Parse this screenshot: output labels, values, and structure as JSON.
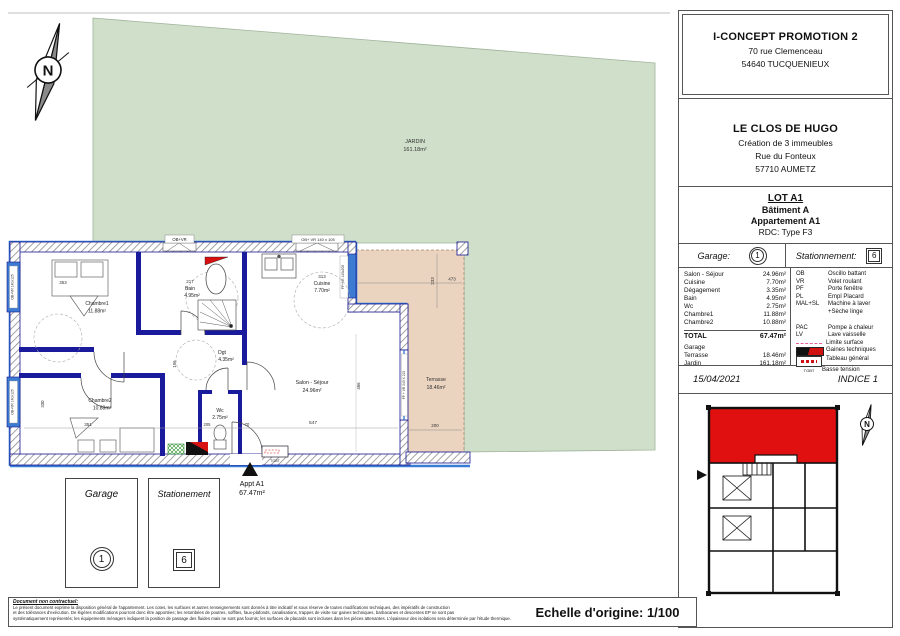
{
  "header": {
    "promoter": {
      "name": "I-CONCEPT PROMOTION 2",
      "address_line1": "70 rue Clemenceau",
      "address_line2": "54640 TUCQUENIEUX"
    },
    "project": {
      "name": "LE CLOS DE HUGO",
      "desc": "Création de 3 immeubles",
      "street": "Rue du Fonteux",
      "city": "57710 AUMETZ"
    },
    "lot": {
      "lot": "LOT A1",
      "building": "Bâtiment A",
      "apartment": "Appartement A1",
      "floor_type": "RDC: Type F3"
    },
    "parking": {
      "garage_label": "Garage:",
      "garage_value": "1",
      "parking_label": "Stationnement:",
      "parking_value": "6"
    },
    "areas": {
      "rooms": [
        {
          "name": "Salon - Séjour",
          "value": "24.96m²"
        },
        {
          "name": "Cuisine",
          "value": "7.70m²"
        },
        {
          "name": "Dégagement",
          "value": "3.35m²"
        },
        {
          "name": "Bain",
          "value": "4.95m²"
        },
        {
          "name": "Wc",
          "value": "2.75m²"
        },
        {
          "name": "Chambre1",
          "value": "11.88m²"
        },
        {
          "name": "Chambre2",
          "value": "10.88m²"
        }
      ],
      "total_label": "TOTAL",
      "total_value": "67.47m²",
      "annexes": [
        {
          "name": "Garage",
          "value": ""
        },
        {
          "name": "Terrasse",
          "value": "18.46m²"
        },
        {
          "name": "Jardin",
          "value": "161.18m²"
        }
      ]
    },
    "legend": {
      "abbrev": [
        {
          "code": "OB",
          "label": "Oscillo battant"
        },
        {
          "code": "VR",
          "label": "Volet roulant"
        },
        {
          "code": "PF",
          "label": "Porte fenêtre"
        },
        {
          "code": "PL",
          "label": "Empl Placard"
        },
        {
          "code": "MAL+SL",
          "label": "Machine à laver"
        },
        {
          "code": "",
          "label": "+Sèche linge"
        },
        {
          "code": "PAC",
          "label": "Pompe à chaleur"
        },
        {
          "code": "LV",
          "label": "Lave vaisselle"
        }
      ],
      "symbols": [
        {
          "label": "Limite surface"
        },
        {
          "label": "Gaines techniques"
        },
        {
          "label": "Tableau général"
        },
        {
          "label": "Basse tension"
        }
      ],
      "tgbt_label": "TGBT"
    },
    "date": "15/04/2021",
    "indice": "INDICE 1"
  },
  "plan": {
    "jardin_name": "JARDIN",
    "jardin_area": "161.18m²",
    "terrasse_name": "Terrasse",
    "terrasse_area": "18.46m²",
    "salon_name": "Salon - Séjour",
    "salon_area": "24.96m²",
    "cuisine_num": "313",
    "cuisine_name": "Cuisine",
    "cuisine_area": "7.70m²",
    "bain_num": "217",
    "bain_name": "Bain",
    "bain_area": "4.95m²",
    "chambre1_name": "Chambre1",
    "chambre1_area": "11.88m²",
    "chambre1_num": "353",
    "chambre2_name": "Chambre2",
    "chambre2_area": "10.88m²",
    "chambre2_num": "351",
    "dgt_name": "Dgt",
    "dgt_area": "4.35m²",
    "wc_name": "Wc",
    "wc_area": "2.75m²",
    "windows": {
      "top_small": "OB+VR",
      "top_cuisine": "OB+ VR 140 x 105",
      "left1": "OB+VR 140x125",
      "left2": "OB+VR 140x125",
      "salon_pf": "PF + VR 240 X 215",
      "cuisine_pf": "PF+VR 140x205"
    },
    "dims": {
      "d547": "547",
      "d200": "200",
      "d473": "473",
      "d233": "233",
      "d466": "466",
      "d330": "330",
      "d196": "196",
      "d205": "205",
      "d70": "70"
    },
    "tgbt": "TGBT",
    "entrance_label": "Appt A1",
    "entrance_area": "67.47m²"
  },
  "legend_boxes": {
    "garage_label": "Garage",
    "garage_value": "1",
    "parking_label": "Stationement",
    "parking_value": "6"
  },
  "footer": {
    "disclaimer_title": "Document non contractuel:",
    "line1": "Le présent document exprime la disposition général de l'appartement. Les cotes, les surfaces et autres renseignements sont donnés à titre indicatif et sous réserve de toutes modifications techniques, des impératifs de construction",
    "line2": "et des tolérances d'exécution. De légères modifications pourront donc être apportées; les retombées de poutres, soffites, faux-plafonds, canalisations, trappes de visite sur gaines techniques, barbacanes et descentes EP ne sont pas",
    "line3": "systématiquement représentés; les équipements ménagers indiquent la position de passage des fluides mais ne sont pas fournis; les surfaces de placards sont incluses dans les pièces attenantes. L'épaisseur des isolations sera déterminée par l'étude thermique.",
    "scale": "Echelle d'origine: 1/100"
  },
  "colors": {
    "garden": "#cfdfca",
    "terrace": "#ead3bf",
    "wall_blue": "#1a1a9c",
    "window_blue": "#3d7ad1",
    "highlight_red": "#e01010"
  }
}
